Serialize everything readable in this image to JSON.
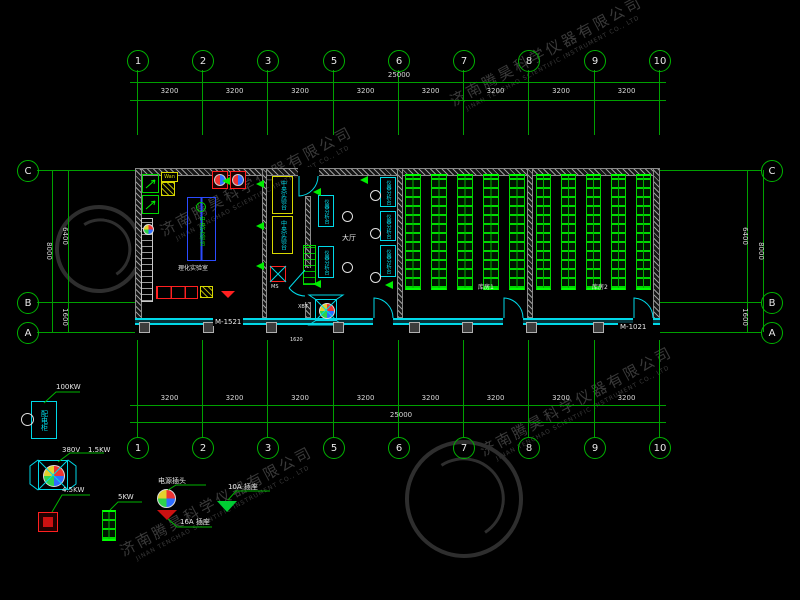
{
  "watermark": {
    "cn": "济南腾昊科学仪器有限公司",
    "en": "JINAN TENGHAO SCIENTIFIC INSTRUMENT CO., LTD"
  },
  "grid": {
    "cols": [
      "1",
      "2",
      "3",
      "5",
      "6",
      "7",
      "8",
      "9",
      "10"
    ],
    "rows": [
      "C",
      "B",
      "A"
    ],
    "bay_dim": "3200",
    "total_dim": "25000",
    "left": {
      "total": "8000",
      "top": "6400",
      "bottom": "1600"
    },
    "right": {
      "total": "8000",
      "top": "6400",
      "bottom": "1600"
    }
  },
  "plan": {
    "room_left_label": "理化实验室",
    "hall_label": "大厅",
    "room1_label": "库房1",
    "room2_label": "库房2",
    "door_left": "M-1521",
    "door_right": "M-1021",
    "bench_central": "中央实验台",
    "bench_instrument": "仪器分析台",
    "tag_ms": "MS",
    "tag_fan": "XBT",
    "tag_hood": "Wan",
    "dim_small": "1620"
  },
  "legend": {
    "cabinet_label": "配电柜",
    "cabinet_power": "100KW",
    "fan_voltage": "380V",
    "fan_power": "1.5KW",
    "red_power": "4.5KW",
    "rack_power": "5KW",
    "plug_label": "电源插头",
    "socket16_label": "16A 插座",
    "socket10_label": "10A 插座"
  }
}
